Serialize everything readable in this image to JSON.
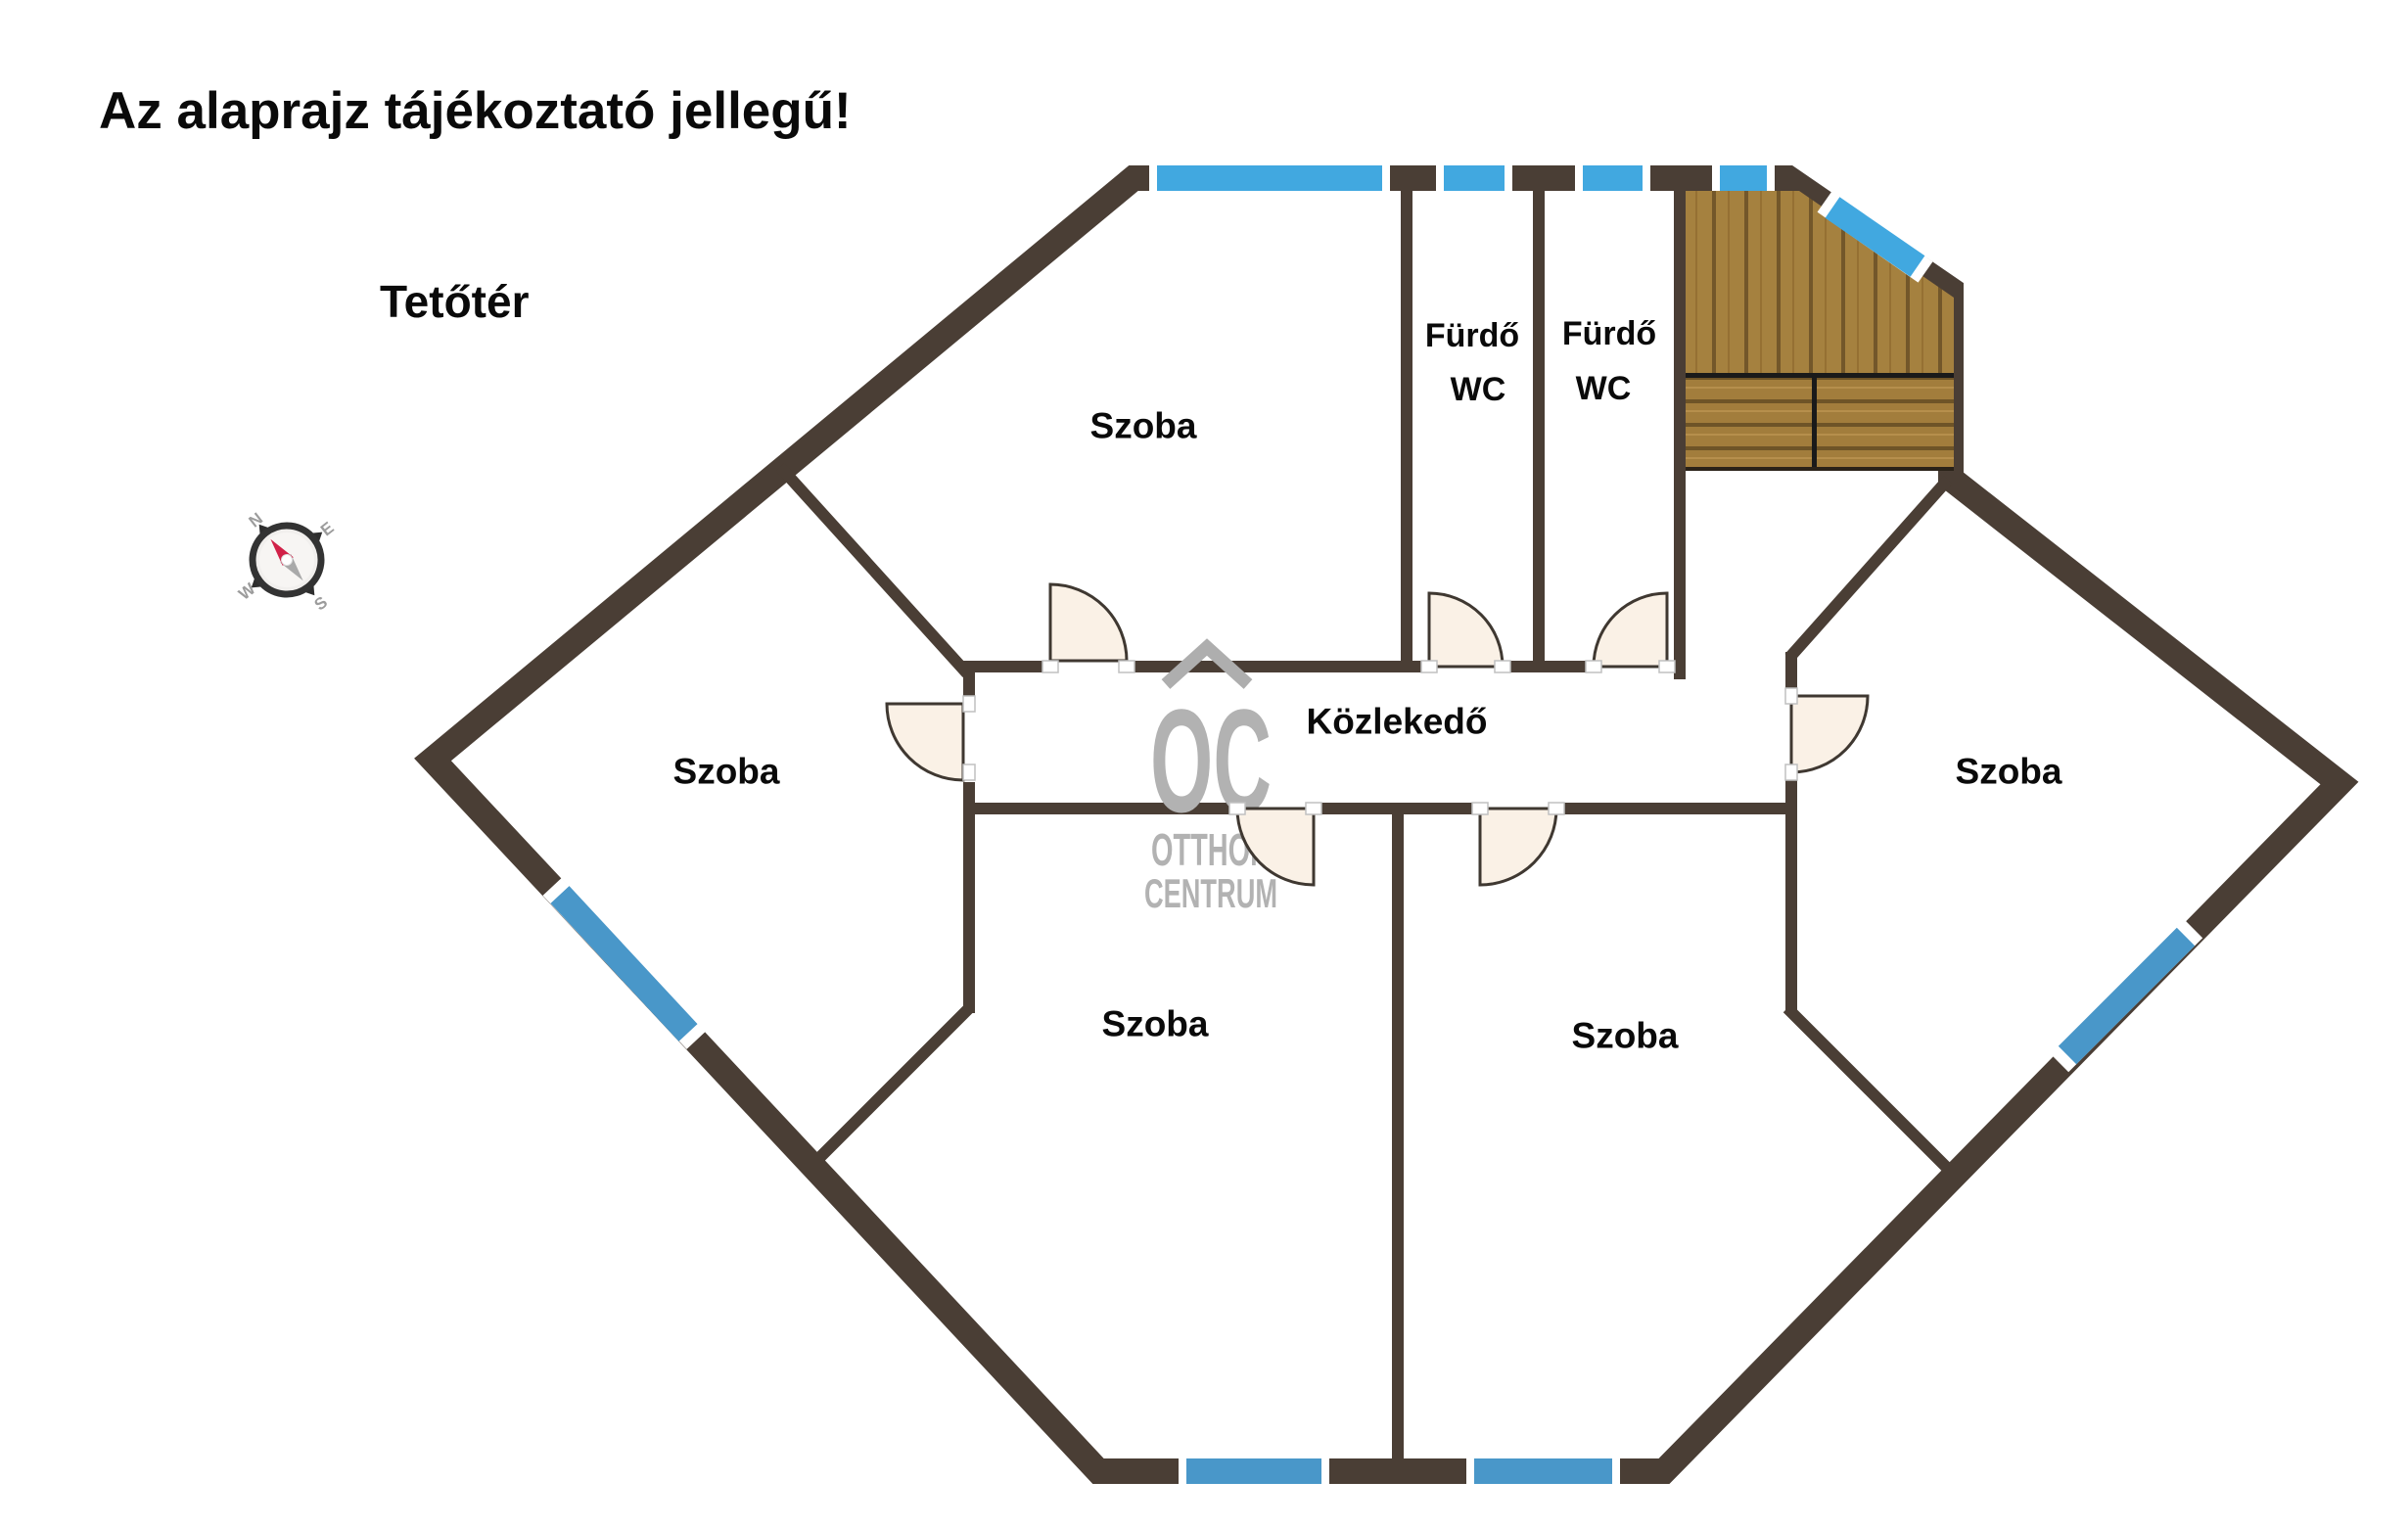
{
  "title": "Az alaprajz tájékoztató jellegű!",
  "floor": {
    "name": "Tetőtér"
  },
  "rooms": {
    "top": "Szoba",
    "left": "Szoba",
    "bottom_left": "Szoba",
    "bottom_right": "Szoba",
    "right": "Szoba",
    "corridor": "Közlekedő",
    "bath_left": {
      "line1": "Fürdő",
      "line2": "WC"
    },
    "bath_right": {
      "line1": "Fürdő",
      "line2": "WC"
    }
  },
  "watermark": {
    "logo": "OC",
    "line1": "OTTHON",
    "line2": "CENTRUM"
  },
  "compass": {
    "n": "N",
    "e": "E",
    "s": "S",
    "w": "W"
  },
  "colors": {
    "wall": "#4a3e35",
    "window_blue": "#41a8e0",
    "window_blue_cool": "#4997c9",
    "door_fill": "#faf1e6",
    "door_stroke": "#3f3831",
    "wood": "#a5813f",
    "wood_dark": "#73572a",
    "watermark": "#b2b2b2",
    "needle_red": "#d12148",
    "needle_gray": "#a9a9a9"
  }
}
